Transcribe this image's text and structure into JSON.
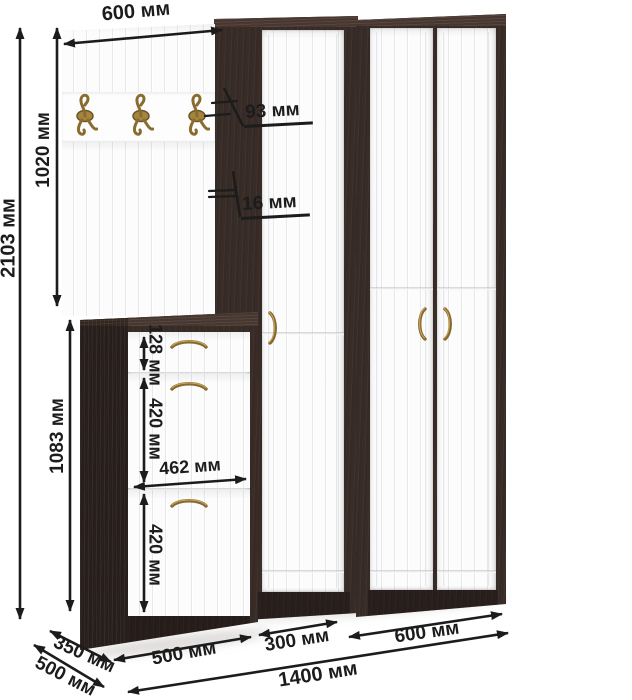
{
  "colors": {
    "background": "#ffffff",
    "carcass_wenge": "#382c27",
    "front_white": "#fcfcfd",
    "hardware_brass": "#8a6c30",
    "annotation": "#1c1c1c"
  },
  "furniture": {
    "hooks_count": 3,
    "right_wardrobe_doors": 2,
    "shoe_cabinet_rows": 3
  },
  "dimensions": {
    "panel_width": {
      "label": "600 мм"
    },
    "total_height": {
      "label": "2103 мм"
    },
    "panel_height": {
      "label": "1020 мм"
    },
    "shoe_cabinet_height": {
      "label": "1083 мм"
    },
    "hook_offset": {
      "label": "93 мм"
    },
    "panel_thickness": {
      "label": "16 мм"
    },
    "drawer_height": {
      "label": "128 мм"
    },
    "upper_flap_height": {
      "label": "420 мм"
    },
    "inner_width": {
      "label": "462 мм"
    },
    "lower_flap_height": {
      "label": "420 мм"
    },
    "shoe_cabinet_width": {
      "label": "500 мм"
    },
    "middle_wardrobe_width": {
      "label": "300 мм"
    },
    "right_wardrobe_width": {
      "label": "600 мм"
    },
    "total_width": {
      "label": "1400 мм"
    },
    "shoe_cabinet_depth": {
      "label": "350 мм"
    },
    "total_depth": {
      "label": "500 мм"
    }
  }
}
